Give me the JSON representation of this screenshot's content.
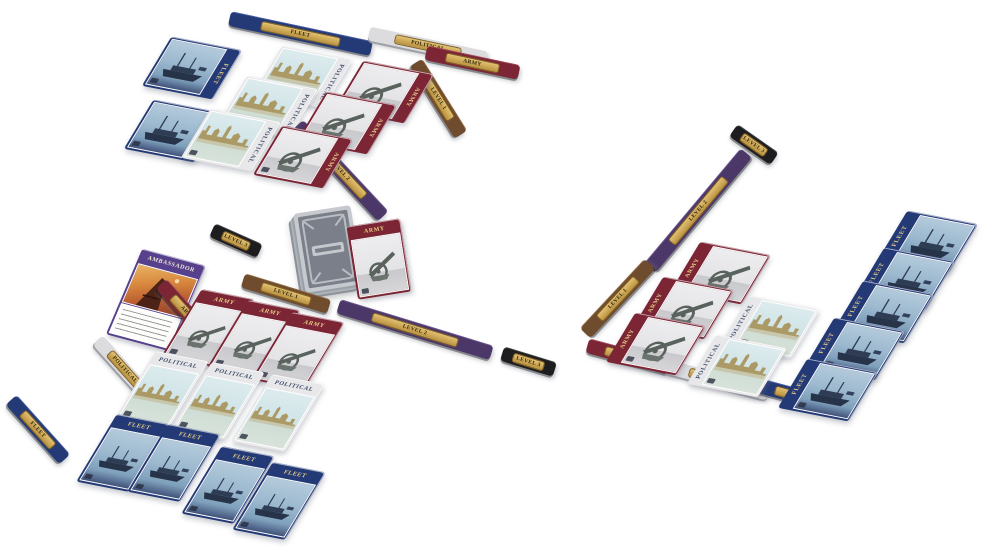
{
  "labels": {
    "army": "ARMY",
    "fleet": "FLEET",
    "political": "POLITICAL",
    "ambassador": "AMBASSADOR",
    "level1": "LEVEL 1",
    "level2": "LEVEL 2",
    "level3": "LEVEL 3"
  },
  "colors": {
    "army_card": "#7b2535",
    "fleet_card": "#243a77",
    "political_card": "#e8e8ea",
    "ambassador_card": "#57408c",
    "stick_brown": "#6f4c2d",
    "stick_purple": "#4c3769",
    "stick_black": "#1d1d1f",
    "plate_gold": "#c9a455",
    "background": "#ffffff"
  },
  "tableaus": {
    "top_left": {
      "fleet_cards": 2,
      "political_cards": 3,
      "army_cards": 3
    },
    "bottom_left": {
      "army_cards": 3,
      "political_cards": 3,
      "fleet_cards": 4
    },
    "right": {
      "army_cards": 3,
      "political_cards": 2,
      "fleet_cards": 5
    },
    "center": {
      "draw_deck_cards": 1,
      "army_cards": 1,
      "ambassador_cards": 1
    }
  }
}
